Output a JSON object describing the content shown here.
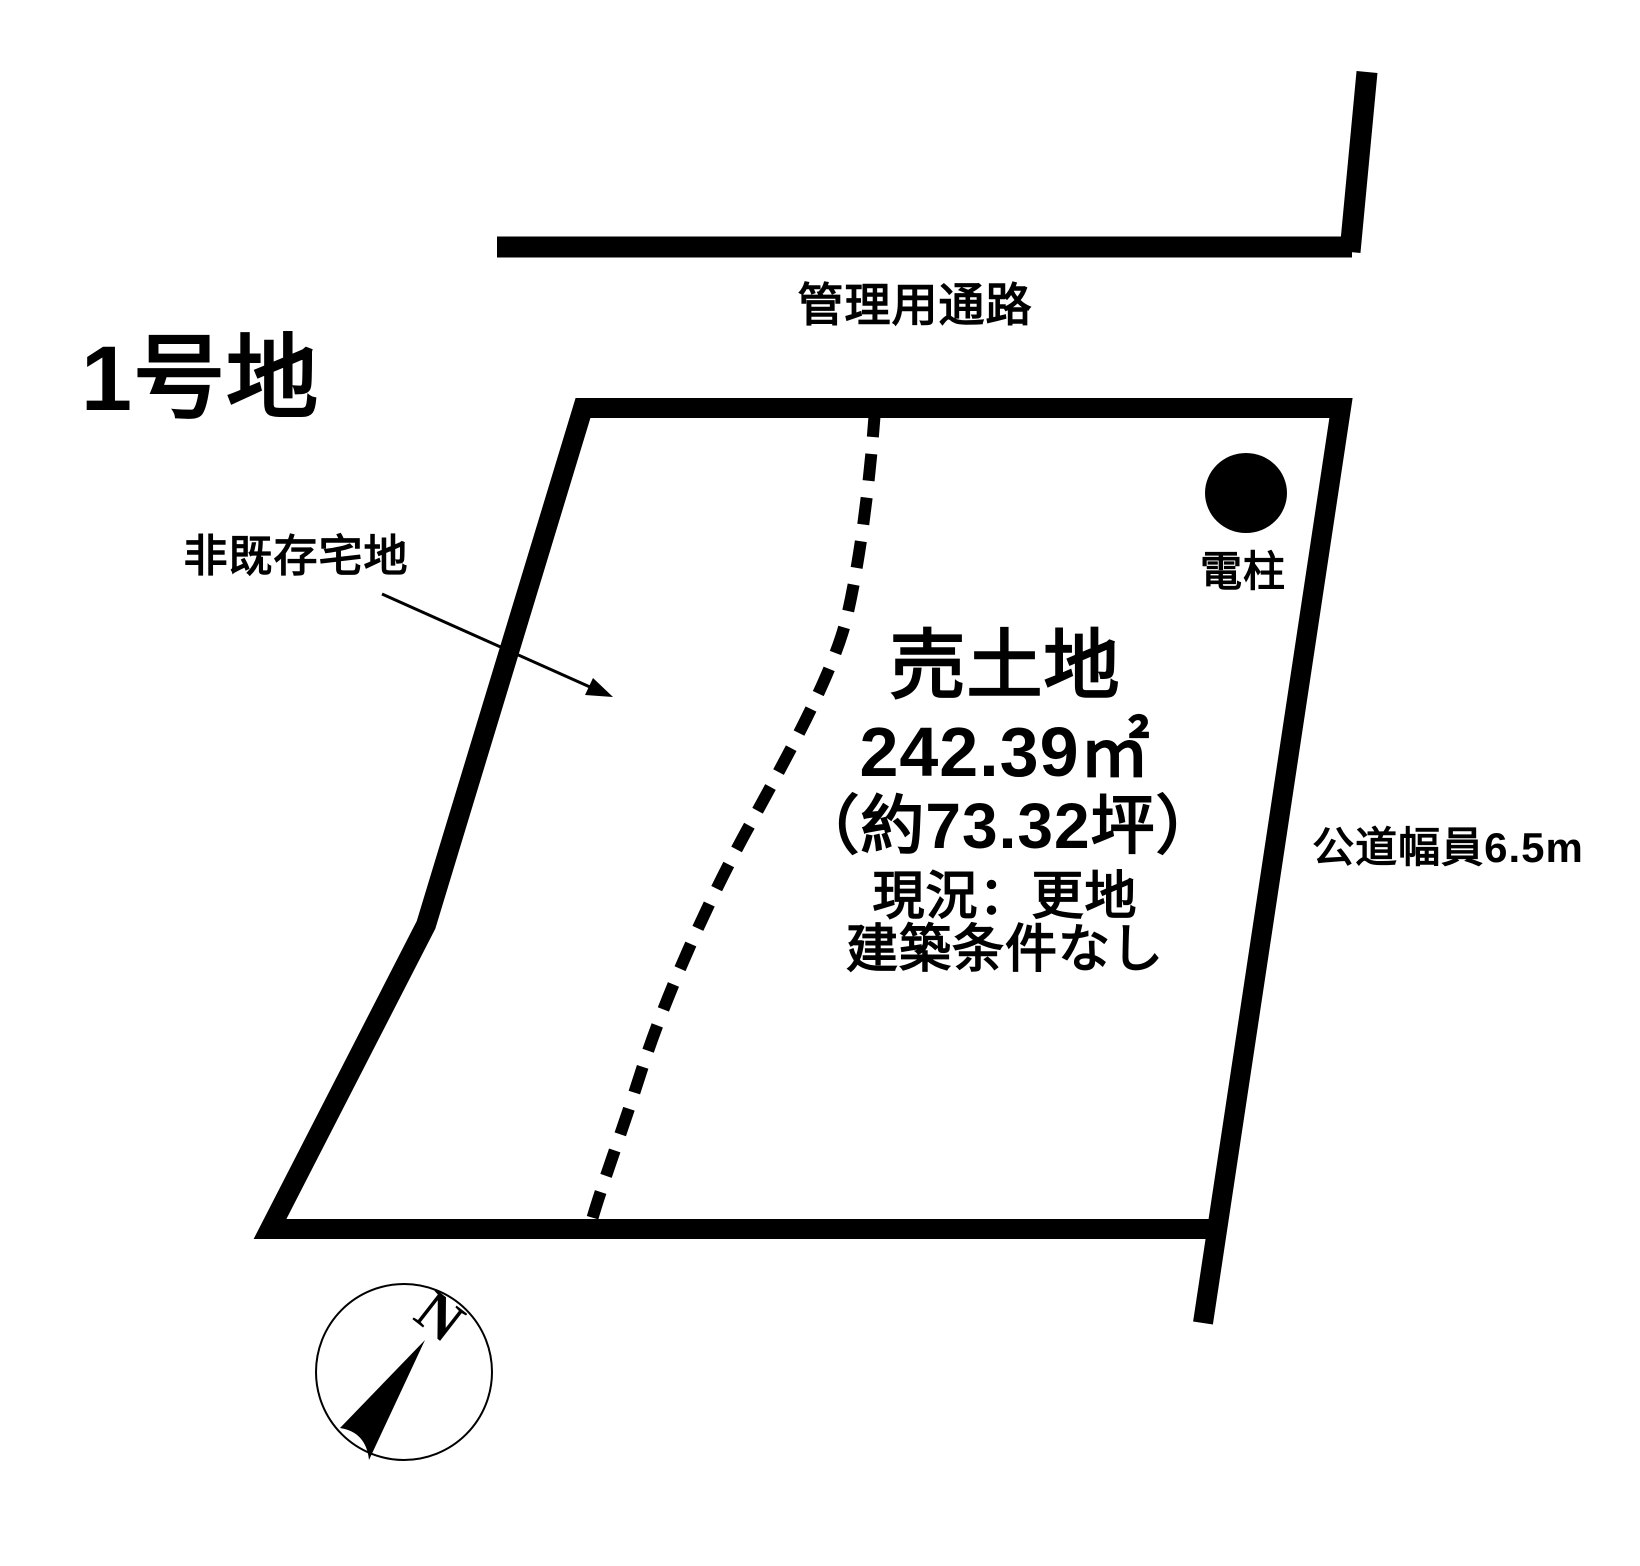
{
  "page": {
    "background_color": "#ffffff",
    "ink_color": "#000000"
  },
  "labels": {
    "lot_number": "1号地",
    "management_passage": "管理用通路",
    "non_existing_residential_land": "非既存宅地",
    "utility_pole": "電柱",
    "public_road_width": "公道幅員6.5m",
    "compass_north": "N"
  },
  "parcel_info": {
    "sale_type": "売土地",
    "area_sqm": "242.39㎡",
    "area_tsubo": "（約73.32坪）",
    "current_state": "現況：更地",
    "building_conditions": "建築条件なし"
  }
}
